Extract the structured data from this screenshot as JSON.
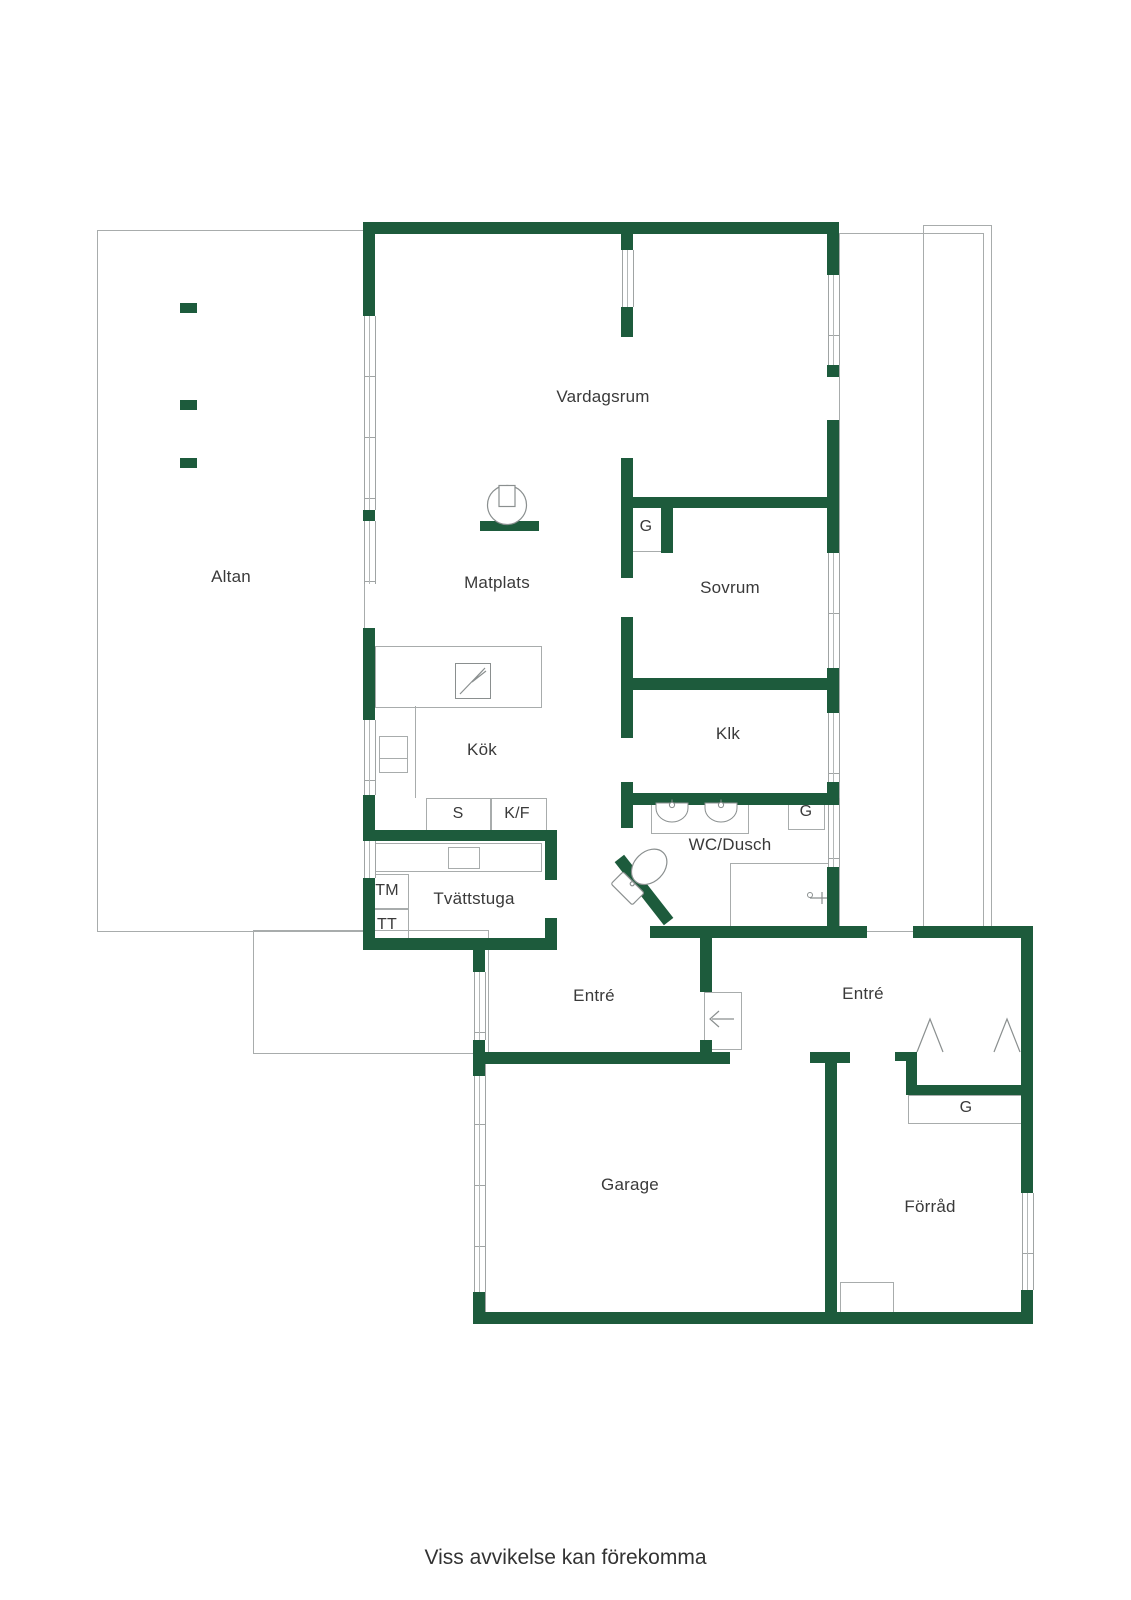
{
  "plan": {
    "rooms": {
      "vardagsrum": "Vardagsrum",
      "altan": "Altan",
      "matplats": "Matplats",
      "sovrum": "Sovrum",
      "kok": "Kök",
      "klk": "Klk",
      "wc_dusch": "WC/Dusch",
      "tvattstuga": "Tvättstuga",
      "entre_inner": "Entré",
      "entre_outer": "Entré",
      "garage": "Garage",
      "forrad": "Förråd"
    },
    "closets": {
      "g_sovrum": "G",
      "g_wc": "G",
      "g_entre": "G"
    },
    "appliances": {
      "s": "S",
      "kf": "K/F",
      "tm": "TM",
      "tt": "TT"
    },
    "footer": {
      "disclaimer": "Viss avvikelse kan förekomma"
    },
    "colors": {
      "wall_green": "#1d5b3c",
      "outline_gray": "#a8acac",
      "fixture_gray": "#8a8f8f",
      "text": "#3a3a3a"
    }
  }
}
